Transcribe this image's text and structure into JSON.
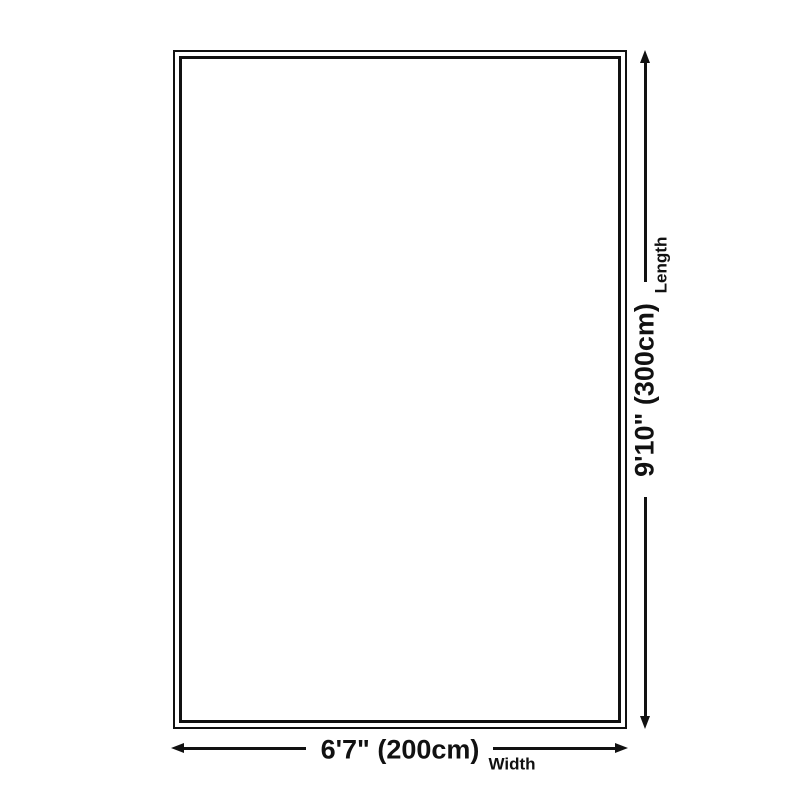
{
  "diagram": {
    "colors": {
      "line": "#111111",
      "background": "#ffffff"
    },
    "width_dimension": {
      "value": "6'7\" (200cm)",
      "label": "Width"
    },
    "length_dimension": {
      "value": "9'10\" (300cm)",
      "label": "Length"
    }
  }
}
